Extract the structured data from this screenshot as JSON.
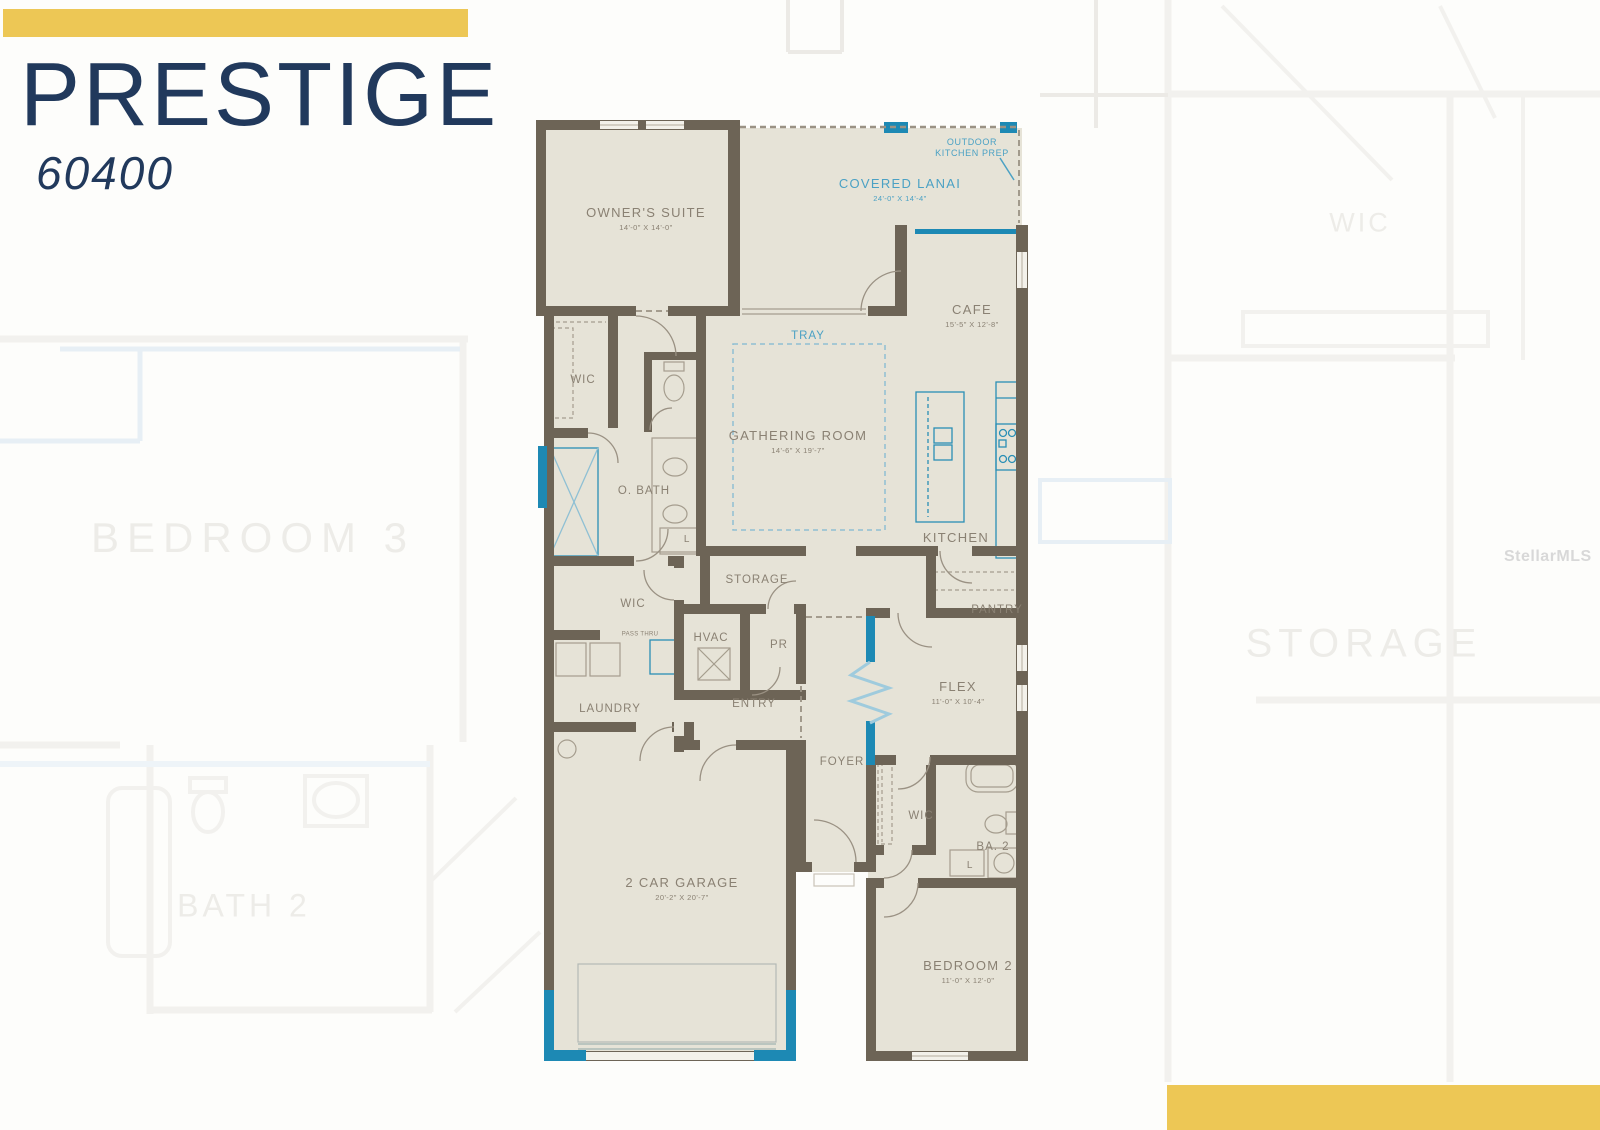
{
  "branding": {
    "bar_color": "#edc755",
    "title": "PRESTIGE",
    "model_number": "60400",
    "title_color": "#21395c"
  },
  "watermark": {
    "text": "StellarMLS"
  },
  "floorplan": {
    "colors": {
      "wall": "#6d6456",
      "floor": "#e6e3d7",
      "accent_teal": "#1d89b4",
      "label": "#8a8173",
      "blue_label": "#4ba1c4"
    },
    "rooms": {
      "owners_suite": {
        "name": "OWNER'S SUITE",
        "dims": "14'-0\" X 14'-0\""
      },
      "outdoor_kitchen_prep": {
        "name": "OUTDOOR KITCHEN PREP"
      },
      "covered_lanai": {
        "name": "COVERED LANAI",
        "dims": "24'-0\" X 14'-4\""
      },
      "cafe": {
        "name": "CAFE",
        "dims": "15'-5\" X 12'-8\""
      },
      "tray": {
        "name": "TRAY"
      },
      "gathering_room": {
        "name": "GATHERING ROOM",
        "dims": "14'-6\" X 19'-7\""
      },
      "owners_wic": {
        "name": "WIC"
      },
      "owners_bath": {
        "name": "O. BATH"
      },
      "kitchen": {
        "name": "KITCHEN"
      },
      "storage": {
        "name": "STORAGE"
      },
      "hall_wic": {
        "name": "WIC"
      },
      "hvac": {
        "name": "HVAC"
      },
      "powder_room": {
        "name": "PR"
      },
      "pantry": {
        "name": "PANTRY"
      },
      "laundry": {
        "name": "LAUNDRY"
      },
      "entry": {
        "name": "ENTRY"
      },
      "flex": {
        "name": "FLEX",
        "dims": "11'-0\" X 10'-4\""
      },
      "foyer": {
        "name": "FOYER"
      },
      "bedroom2_wic": {
        "name": "WIC"
      },
      "bath2": {
        "name": "BA. 2"
      },
      "garage": {
        "name": "2 CAR GARAGE",
        "dims": "20'-2\" X 20'-7\""
      },
      "bedroom2": {
        "name": "BEDROOM 2",
        "dims": "11'-0\" X 12'-0\""
      }
    },
    "small_labels": {
      "linen_owners_bath": "L",
      "linen_hall": "L",
      "pass_thru": "PASS THRU"
    }
  },
  "background_plan": {
    "labels": {
      "bedroom3": "BEDROOM 3",
      "bath2": "BATH 2",
      "wic": "WIC",
      "storage": "STORAGE"
    }
  }
}
